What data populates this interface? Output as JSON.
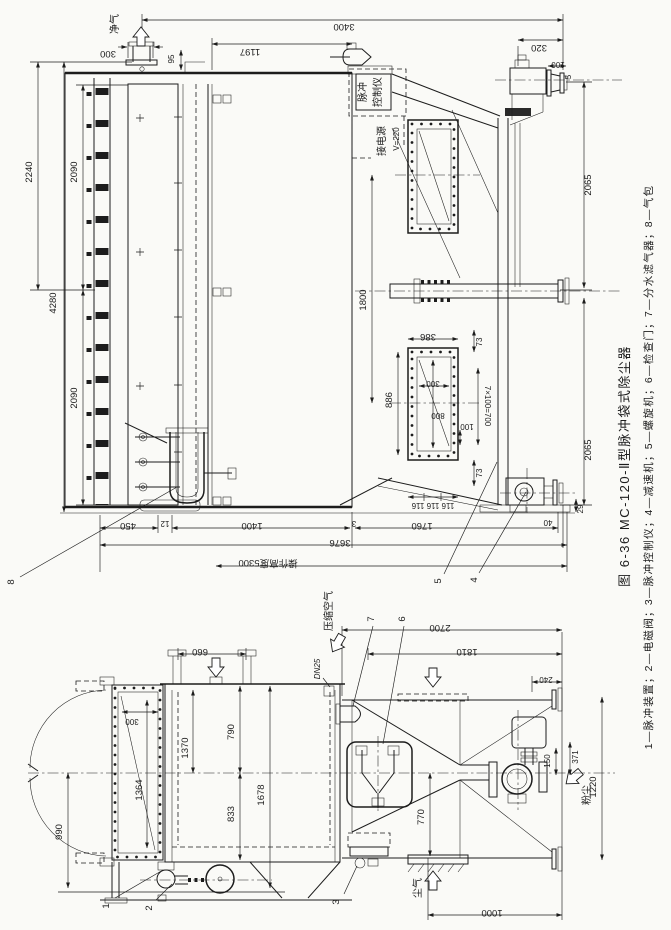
{
  "figure": {
    "caption_title": "图 6-36  MC-120-Ⅱ型脉冲袋式除尘器",
    "caption_legend": "1—脉冲装置；2—电磁阀；3—脉冲控制仪；4—减速机；5—螺旋机；6—检查门；7—分水滤气器；8—气包"
  },
  "colors": {
    "ink": "#1c1c1c",
    "paper": "#fafaf7"
  },
  "annotations": {
    "clean_gas": "净气",
    "compressed_air": "压缩空气",
    "dusty_gas": "尘气",
    "dust": "粉尘",
    "pipe_size": "DN25",
    "controller_line1": "脉冲",
    "controller_line2": "控制仪",
    "power_line1": "接电源",
    "power_line2": "V=220",
    "operating_height": "操作高度5300"
  },
  "part_numbers": {
    "p1": "1",
    "p2": "2",
    "p3": "3",
    "p4": "4",
    "p5": "5",
    "p6": "6",
    "p7": "7",
    "p8": "8"
  },
  "dims_front": {
    "v3400": "3400",
    "v1197": "1197",
    "v300_stub": "300",
    "v95": "95",
    "v320": "320",
    "v100_flange": "100",
    "v5": "5",
    "v2240": "2240",
    "v2090_upper": "2090",
    "v2090_lower": "2090",
    "v4280": "4280",
    "v2065_upper": "2065",
    "v2065_lower": "2065",
    "v1800": "1800",
    "v386": "386",
    "v73_a": "73",
    "v73_b": "73",
    "v886": "886",
    "v300_win": "300",
    "v800": "800",
    "v100_win": "100",
    "v7x100": "7×100=700",
    "v116": "116 116 116",
    "v450": "450",
    "v12": "12",
    "v1400": "1400",
    "v3": "3",
    "v1760": "1760",
    "v40": "40",
    "v29": "29",
    "v3676": "3676"
  },
  "dims_side": {
    "v660": "660",
    "v300_door": "300",
    "v1370": "1370",
    "v790": "790",
    "v833": "833",
    "v1678": "1678",
    "v1364": "1364",
    "v990": "990",
    "v2700": "2700",
    "v1810": "1810",
    "v240": "240",
    "v150": "150",
    "v371": "371",
    "v1220": "1220",
    "v770": "770",
    "v1000": "1000"
  }
}
